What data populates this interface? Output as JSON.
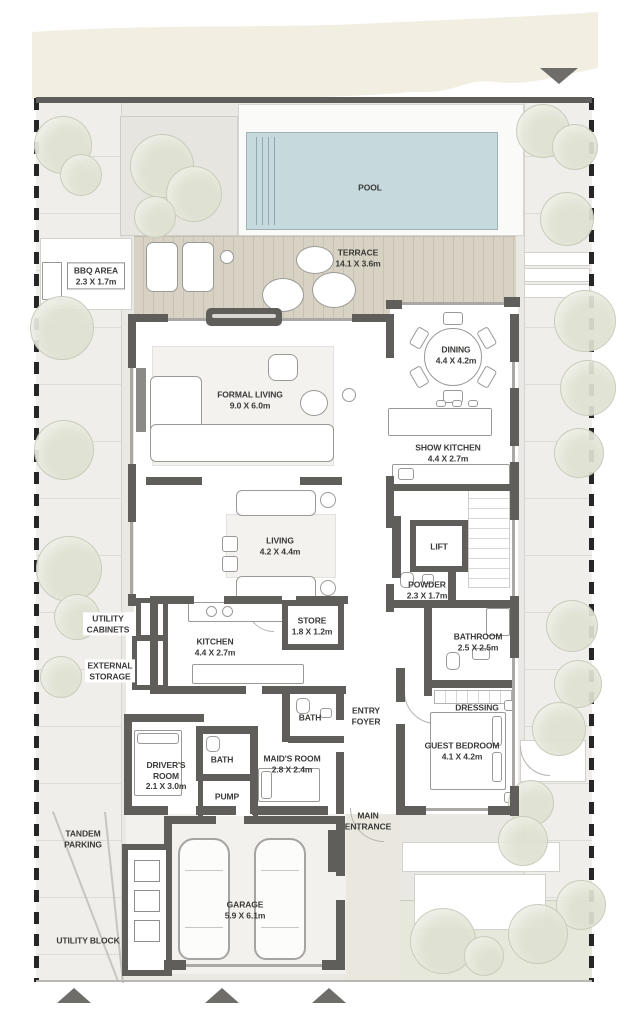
{
  "colors": {
    "wall": "#5f5e5b",
    "ground": "#eae8e3",
    "walkway": "#efeeea",
    "band": "#f3eee2",
    "pool": "#c6dade",
    "pool-line": "#8fa9ae",
    "terrace": "#d8d2c4",
    "terrace-line": "#c9c2b2",
    "tree": "#dfe2d2",
    "tree-edge": "#c6cab8",
    "garden": "#e5e8da",
    "rug": "#f3f2ef",
    "furniture-edge": "#9a9996",
    "label": "#3b3a38",
    "marker": "#6e6d6a",
    "boundary": "#262626",
    "glass": "#a9a8a5"
  },
  "rooms": [
    {
      "id": "pool",
      "name": "POOL",
      "dims": ""
    },
    {
      "id": "terrace",
      "name": "TERRACE",
      "dims": "14.1 X 3.6m"
    },
    {
      "id": "bbq_area",
      "name": "BBQ AREA",
      "dims": "2.3 X 1.7m"
    },
    {
      "id": "formal_living",
      "name": "FORMAL LIVING",
      "dims": "9.0 X 6.0m"
    },
    {
      "id": "dining",
      "name": "DINING",
      "dims": "4.4 X 4.2m"
    },
    {
      "id": "show_kitchen",
      "name": "SHOW KITCHEN",
      "dims": "4.4 X 2.7m"
    },
    {
      "id": "living",
      "name": "LIVING",
      "dims": "4.2 X 4.4m"
    },
    {
      "id": "lift",
      "name": "LIFT",
      "dims": ""
    },
    {
      "id": "powder",
      "name": "POWDER",
      "dims": "2.3 X 1.7m"
    },
    {
      "id": "kitchen",
      "name": "KITCHEN",
      "dims": "4.4 X 2.7m"
    },
    {
      "id": "store",
      "name": "STORE",
      "dims": "1.8 X 1.2m"
    },
    {
      "id": "utility_cabinets",
      "name": "UTILITY CABINETS",
      "dims": ""
    },
    {
      "id": "external_storage",
      "name": "EXTERNAL STORAGE",
      "dims": ""
    },
    {
      "id": "bathroom",
      "name": "BATHROOM",
      "dims": "2.5 X 2.5m"
    },
    {
      "id": "dressing",
      "name": "DRESSING",
      "dims": ""
    },
    {
      "id": "guest_bedroom",
      "name": "GUEST BEDROOM",
      "dims": "4.1 X 4.2m"
    },
    {
      "id": "entry_foyer",
      "name": "ENTRY FOYER",
      "dims": ""
    },
    {
      "id": "bath_maids",
      "name": "BATH",
      "dims": ""
    },
    {
      "id": "maids_room",
      "name": "MAID'S ROOM",
      "dims": "2.8 X 2.4m"
    },
    {
      "id": "drivers_room",
      "name": "DRIVER'S ROOM",
      "dims": "2.1 X 3.0m"
    },
    {
      "id": "bath_drivers",
      "name": "BATH",
      "dims": ""
    },
    {
      "id": "pump",
      "name": "PUMP",
      "dims": ""
    },
    {
      "id": "main_entrance",
      "name": "MAIN ENTRANCE",
      "dims": ""
    },
    {
      "id": "tandem_parking",
      "name": "TANDEM PARKING",
      "dims": ""
    },
    {
      "id": "garage",
      "name": "GARAGE",
      "dims": "5.9 X 6.1m"
    },
    {
      "id": "utility_block",
      "name": "UTILITY BLOCK",
      "dims": ""
    }
  ]
}
